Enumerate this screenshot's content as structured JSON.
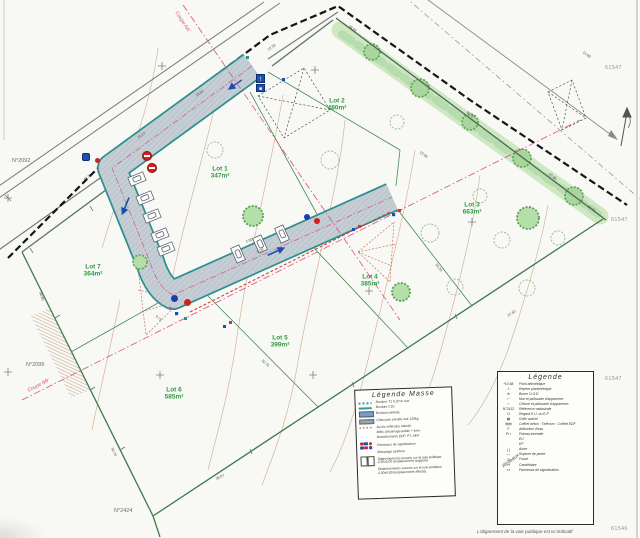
{
  "footnote": "L'alignement de la voie publique est ici indicatif",
  "lots": [
    {
      "name": "Lot 1",
      "area": "347m²",
      "x": 220,
      "y": 173
    },
    {
      "name": "Lot 2",
      "area": "480m²",
      "x": 337,
      "y": 105
    },
    {
      "name": "Lot 3",
      "area": "663m²",
      "x": 472,
      "y": 209
    },
    {
      "name": "Lot 4",
      "area": "385m²",
      "x": 370,
      "y": 281
    },
    {
      "name": "Lot 5",
      "area": "399m²",
      "x": 280,
      "y": 342
    },
    {
      "name": "Lot 6",
      "area": "585m²",
      "x": 174,
      "y": 394
    },
    {
      "name": "Lot 7",
      "area": "364m²",
      "x": 93,
      "y": 271
    }
  ],
  "parcels": [
    {
      "label": "N°2092",
      "x": 12,
      "y": 158
    },
    {
      "label": "N°2095",
      "x": 26,
      "y": 362
    },
    {
      "label": "N°2424",
      "x": 114,
      "y": 508
    }
  ],
  "margin_numbers": [
    {
      "label": "61547",
      "x": 605,
      "y": 65
    },
    {
      "label": "61547",
      "x": 611,
      "y": 217
    },
    {
      "label": "61547",
      "x": 605,
      "y": 376
    },
    {
      "label": "61546",
      "x": 611,
      "y": 526
    }
  ],
  "sections": [
    {
      "label": "Coupe AA'",
      "x": 176,
      "y": 9,
      "rot": 57
    },
    {
      "label": "Coupe BB'",
      "x": 28,
      "y": 388,
      "rot": -27
    }
  ],
  "dims": [
    {
      "t": "14.99",
      "x": 583,
      "y": 50,
      "r": 36
    },
    {
      "t": "38.97",
      "x": 349,
      "y": 24,
      "r": 36
    },
    {
      "t": "21.37",
      "x": 467,
      "y": 110,
      "r": 36
    },
    {
      "t": "27.86",
      "x": 549,
      "y": 172,
      "r": 36
    },
    {
      "t": "24.01",
      "x": 588,
      "y": 204,
      "r": 36
    },
    {
      "t": "15.06",
      "x": 420,
      "y": 150,
      "r": 36
    },
    {
      "t": "40.33",
      "x": 84,
      "y": 178,
      "r": -36
    },
    {
      "t": "25.27",
      "x": 138,
      "y": 136,
      "r": -36
    },
    {
      "t": "18.50",
      "x": 196,
      "y": 94,
      "r": -36
    },
    {
      "t": "12.39",
      "x": 268,
      "y": 48,
      "r": -36
    },
    {
      "t": "46.80",
      "x": 40,
      "y": 290,
      "r": 70
    },
    {
      "t": "50.70",
      "x": 112,
      "y": 446,
      "r": 66
    },
    {
      "t": "35.07",
      "x": 216,
      "y": 477,
      "r": -26
    },
    {
      "t": "36.97",
      "x": 405,
      "y": 391,
      "r": -28
    },
    {
      "t": "27.50",
      "x": 508,
      "y": 314,
      "r": -34
    },
    {
      "t": "32.70",
      "x": 262,
      "y": 358,
      "r": 43
    },
    {
      "t": "30.20",
      "x": 436,
      "y": 262,
      "r": 53
    },
    {
      "t": "2.50",
      "x": 246,
      "y": 240,
      "r": -24
    },
    {
      "t": "5.00",
      "x": 257,
      "y": 250,
      "r": -24
    },
    {
      "t": "9.75",
      "x": 156,
      "y": 314,
      "r": 43
    }
  ],
  "legend_masse": {
    "title": "Légende  Masse",
    "items": [
      {
        "sw": "dashteal",
        "label": "Bordure T1 0,20 m vue"
      },
      {
        "sw": "solidteal",
        "label": "Bordure CS1"
      },
      {
        "sw": "barblue",
        "label": "Bordure parking"
      },
      {
        "sw": "bargray",
        "label": "Chaussée enrobé noir 120kg"
      },
      {
        "sw": "dashred",
        "label": "Accès véhicules interdit"
      },
      {
        "sw": "none",
        "label": "Mâts d'éclairage public + lumi."
      },
      {
        "sw": "none",
        "label": "Branchements EDF, PT, AEP"
      },
      {
        "sw": "signs",
        "label": "Panneaux de signalisation"
      },
      {
        "sw": "none",
        "label": "Marquage peinture"
      },
      {
        "sw": "bays",
        "label": "Stationnements ouverts sur la voie publique 2,50x5,00 (emplacement suggéré)"
      },
      {
        "sw": "none",
        "label": "Stationnements ouverts sur la voie publique 2,50x5,00 (emplacement affecté)"
      }
    ]
  },
  "legend_right": {
    "title": "Légende",
    "annotation": "Réseaux",
    "items": [
      {
        "sym": "*10.58",
        "label": "Point altimétrique"
      },
      {
        "sym": "-+-",
        "label": "Repère planimétrique"
      },
      {
        "sym": "⊕",
        "label": "Borne O.G.E."
      },
      {
        "sym": "⌐·",
        "label": "Mur et palissade d'apparence"
      },
      {
        "sym": "⌐·",
        "label": "Clôture et palissade d'apparence"
      },
      {
        "sym": "N°2412",
        "label": "Référence cadastrale"
      },
      {
        "sym": "O",
        "label": "Regard E.U. ou E.P."
      },
      {
        "sym": "▦",
        "label": "Grille avaloir"
      },
      {
        "sym": "▤▤",
        "label": "Coffret béton · Télécom · Coffret EDF"
      },
      {
        "sym": "F",
        "label": "Adduction d'eau"
      },
      {
        "sym": "Pi •",
        "label": "Poteau incendie"
      },
      {
        "sym": "",
        "label": "EU"
      },
      {
        "sym": "",
        "label": "EP"
      },
      {
        "sym": "( )",
        "label": "Arbre"
      },
      {
        "sym": "~~",
        "label": "Rupture de pente"
      },
      {
        "sym": "///",
        "label": "Fossé"
      },
      {
        "sym": "-¤",
        "label": "Candélabre"
      },
      {
        "sym": "××",
        "label": "Panneaux de signalisation"
      }
    ]
  }
}
